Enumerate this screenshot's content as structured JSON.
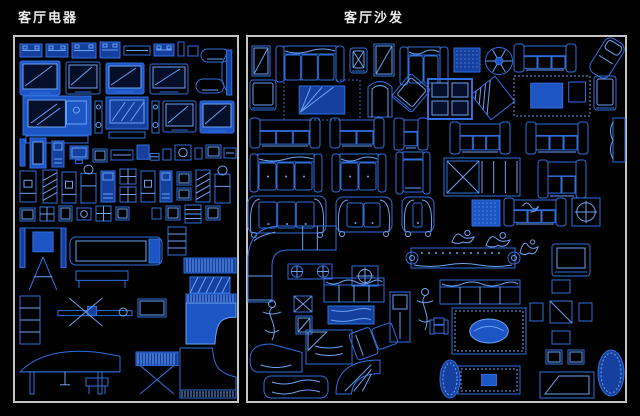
{
  "app": {
    "kind": "cad-block-library-sheet",
    "background": "#000000"
  },
  "colors": {
    "line": "#2f6fe0",
    "bright": "#6aa2f2",
    "fill": "#1d55c4",
    "dfill": "#16409f",
    "screen": "#060f2a",
    "border": "#c4c4c4",
    "title": "#ececec"
  },
  "panels": [
    {
      "id": "appliances",
      "title": "客厅电器",
      "frame": {
        "x": 14,
        "y": 36,
        "w": 224,
        "h": 366
      },
      "title_pos": {
        "x": 18,
        "y": 7
      },
      "items": [
        {
          "t": "unit",
          "x": 20,
          "y": 44,
          "w": 22,
          "h": 13
        },
        {
          "t": "unit",
          "x": 46,
          "y": 44,
          "w": 22,
          "h": 13
        },
        {
          "t": "unit",
          "x": 72,
          "y": 43,
          "w": 24,
          "h": 15
        },
        {
          "t": "unit",
          "x": 100,
          "y": 42,
          "w": 20,
          "h": 16
        },
        {
          "t": "flat",
          "x": 124,
          "y": 46,
          "w": 26,
          "h": 9
        },
        {
          "t": "unit",
          "x": 154,
          "y": 44,
          "w": 20,
          "h": 12
        },
        {
          "t": "tiny",
          "x": 178,
          "y": 42,
          "w": 6,
          "h": 14
        },
        {
          "t": "tiny",
          "x": 188,
          "y": 46,
          "w": 10,
          "h": 10
        },
        {
          "t": "lounge",
          "x": 201,
          "y": 49,
          "w": 28,
          "h": 13
        },
        {
          "t": "tv",
          "x": 20,
          "y": 61,
          "w": 40,
          "h": 34,
          "f": 1
        },
        {
          "t": "tv",
          "x": 66,
          "y": 62,
          "w": 34,
          "h": 32
        },
        {
          "t": "tv",
          "x": 106,
          "y": 63,
          "w": 38,
          "h": 31,
          "f": 1
        },
        {
          "t": "tv",
          "x": 150,
          "y": 64,
          "w": 38,
          "h": 30
        },
        {
          "t": "lounge",
          "x": 196,
          "y": 79,
          "w": 28,
          "h": 14
        },
        {
          "t": "tvside",
          "x": 222,
          "y": 50,
          "w": 13,
          "h": 45
        },
        {
          "t": "bigtv",
          "x": 23,
          "y": 96,
          "w": 68,
          "h": 47
        },
        {
          "t": "spk2",
          "x": 95,
          "y": 101,
          "w": 7,
          "h": 32
        },
        {
          "t": "hatchtv",
          "x": 106,
          "y": 97,
          "w": 42,
          "h": 32
        },
        {
          "t": "spk2",
          "x": 152,
          "y": 101,
          "w": 7,
          "h": 32
        },
        {
          "t": "tv",
          "x": 163,
          "y": 101,
          "w": 33,
          "h": 31
        },
        {
          "t": "tv",
          "x": 200,
          "y": 101,
          "w": 34,
          "h": 32,
          "f": 1
        },
        {
          "t": "pen",
          "x": 20,
          "y": 139,
          "w": 5,
          "h": 27
        },
        {
          "t": "darkcol",
          "x": 30,
          "y": 138,
          "w": 16,
          "h": 30
        },
        {
          "t": "col",
          "x": 52,
          "y": 141,
          "w": 12,
          "h": 26
        },
        {
          "t": "pc",
          "x": 70,
          "y": 146,
          "w": 18,
          "h": 18
        },
        {
          "t": "box",
          "x": 93,
          "y": 149,
          "w": 14,
          "h": 13
        },
        {
          "t": "flat",
          "x": 111,
          "y": 150,
          "w": 22,
          "h": 10
        },
        {
          "t": "pckb",
          "x": 137,
          "y": 145,
          "w": 22,
          "h": 19
        },
        {
          "t": "tiny",
          "x": 163,
          "y": 149,
          "w": 8,
          "h": 11
        },
        {
          "t": "boxc",
          "x": 175,
          "y": 145,
          "w": 16,
          "h": 15
        },
        {
          "t": "tiny",
          "x": 195,
          "y": 148,
          "w": 7,
          "h": 11
        },
        {
          "t": "box",
          "x": 206,
          "y": 145,
          "w": 15,
          "h": 13
        },
        {
          "t": "flat",
          "x": 224,
          "y": 148,
          "w": 12,
          "h": 10
        },
        {
          "t": "disp",
          "x": 20,
          "y": 171,
          "w": 16,
          "h": 31
        },
        {
          "t": "colh",
          "x": 43,
          "y": 170,
          "w": 14,
          "h": 33
        },
        {
          "t": "disp",
          "x": 62,
          "y": 172,
          "w": 14,
          "h": 31
        },
        {
          "t": "bottle",
          "x": 81,
          "y": 165,
          "w": 15,
          "h": 38
        },
        {
          "t": "col",
          "x": 101,
          "y": 171,
          "w": 14,
          "h": 31
        },
        {
          "t": "gridbox",
          "x": 120,
          "y": 169,
          "w": 16,
          "h": 15
        },
        {
          "t": "gridbox",
          "x": 120,
          "y": 187,
          "w": 16,
          "h": 15
        },
        {
          "t": "disp",
          "x": 141,
          "y": 171,
          "w": 14,
          "h": 31
        },
        {
          "t": "col",
          "x": 160,
          "y": 171,
          "w": 12,
          "h": 31
        },
        {
          "t": "box",
          "x": 177,
          "y": 172,
          "w": 14,
          "h": 13
        },
        {
          "t": "box",
          "x": 177,
          "y": 188,
          "w": 14,
          "h": 12
        },
        {
          "t": "colh",
          "x": 196,
          "y": 170,
          "w": 14,
          "h": 32
        },
        {
          "t": "bottle",
          "x": 215,
          "y": 166,
          "w": 15,
          "h": 37
        },
        {
          "t": "box",
          "x": 20,
          "y": 208,
          "w": 15,
          "h": 13
        },
        {
          "t": "gridbox",
          "x": 40,
          "y": 207,
          "w": 14,
          "h": 14
        },
        {
          "t": "box",
          "x": 59,
          "y": 206,
          "w": 13,
          "h": 15
        },
        {
          "t": "boxc",
          "x": 77,
          "y": 208,
          "w": 14,
          "h": 12
        },
        {
          "t": "gridbox",
          "x": 96,
          "y": 206,
          "w": 15,
          "h": 15
        },
        {
          "t": "box",
          "x": 116,
          "y": 207,
          "w": 13,
          "h": 13
        },
        {
          "t": "tiny",
          "x": 152,
          "y": 208,
          "w": 9,
          "h": 11
        },
        {
          "t": "box",
          "x": 166,
          "y": 206,
          "w": 14,
          "h": 14
        },
        {
          "t": "gridstack",
          "x": 185,
          "y": 205,
          "w": 16,
          "h": 18
        },
        {
          "t": "box",
          "x": 206,
          "y": 206,
          "w": 14,
          "h": 14
        },
        {
          "t": "machine",
          "x": 20,
          "y": 224,
          "w": 46,
          "h": 66
        },
        {
          "t": "treadmill",
          "x": 70,
          "y": 237,
          "w": 92,
          "h": 28
        },
        {
          "t": "bench",
          "x": 76,
          "y": 271,
          "w": 52,
          "h": 17
        },
        {
          "t": "gridstack",
          "x": 168,
          "y": 227,
          "w": 18,
          "h": 28
        },
        {
          "t": "keys",
          "x": 184,
          "y": 258,
          "w": 52,
          "h": 15
        },
        {
          "t": "hatchbox",
          "x": 190,
          "y": 277,
          "w": 40,
          "h": 16
        },
        {
          "t": "rack",
          "x": 20,
          "y": 296,
          "w": 20,
          "h": 48
        },
        {
          "t": "rowing",
          "x": 58,
          "y": 298,
          "w": 74,
          "h": 28
        },
        {
          "t": "box",
          "x": 138,
          "y": 299,
          "w": 28,
          "h": 18
        },
        {
          "t": "gpianoT",
          "x": 186,
          "y": 294,
          "w": 50,
          "h": 50
        },
        {
          "t": "gpianoS",
          "x": 20,
          "y": 348,
          "w": 100,
          "h": 46
        },
        {
          "t": "stool",
          "x": 86,
          "y": 378,
          "w": 22,
          "h": 16
        },
        {
          "t": "synthstand",
          "x": 136,
          "y": 352,
          "w": 42,
          "h": 42
        },
        {
          "t": "gpianoO",
          "x": 180,
          "y": 348,
          "w": 56,
          "h": 50
        }
      ]
    },
    {
      "id": "sofas",
      "title": "客厅沙发",
      "frame": {
        "x": 247,
        "y": 36,
        "w": 379,
        "h": 366
      },
      "title_pos": {
        "x": 344,
        "y": 7
      },
      "items": [
        {
          "t": "cab",
          "x": 252,
          "y": 46,
          "w": 18,
          "h": 30
        },
        {
          "t": "sofa3top",
          "x": 276,
          "y": 46,
          "w": 68,
          "h": 36,
          "n": 3
        },
        {
          "t": "armtop",
          "x": 350,
          "y": 48,
          "w": 17,
          "h": 25,
          "X": 1
        },
        {
          "t": "cab",
          "x": 374,
          "y": 44,
          "w": 20,
          "h": 32
        },
        {
          "t": "sofa3top",
          "x": 400,
          "y": 47,
          "w": 48,
          "h": 38,
          "n": 2
        },
        {
          "t": "dotsq",
          "x": 454,
          "y": 48,
          "w": 26,
          "h": 24
        },
        {
          "t": "flower",
          "x": 484,
          "y": 46,
          "w": 30,
          "h": 30
        },
        {
          "t": "sofafront",
          "x": 514,
          "y": 44,
          "w": 62,
          "h": 28,
          "n": 3
        },
        {
          "t": "rotlounge",
          "x": 596,
          "y": 38,
          "w": 22,
          "h": 40,
          "r": 32
        },
        {
          "t": "armtop",
          "x": 250,
          "y": 80,
          "w": 26,
          "h": 30
        },
        {
          "t": "setrug",
          "x": 284,
          "y": 80,
          "w": 76,
          "h": 40
        },
        {
          "t": "wing",
          "x": 368,
          "y": 79,
          "w": 24,
          "h": 38
        },
        {
          "t": "armtop",
          "x": 398,
          "y": 78,
          "w": 26,
          "h": 30,
          "r": 40
        },
        {
          "t": "win4",
          "x": 428,
          "y": 79,
          "w": 44,
          "h": 40
        },
        {
          "t": "hatchsq",
          "x": 478,
          "y": 82,
          "w": 30,
          "h": 32,
          "r": -38
        },
        {
          "t": "set",
          "x": 514,
          "y": 76,
          "w": 76,
          "h": 40
        },
        {
          "t": "armtop",
          "x": 594,
          "y": 76,
          "w": 22,
          "h": 34
        },
        {
          "t": "sofaside",
          "x": 613,
          "y": 118,
          "w": 12,
          "h": 44
        },
        {
          "t": "sofafront",
          "x": 250,
          "y": 118,
          "w": 70,
          "h": 30,
          "n": 3
        },
        {
          "t": "sofafront",
          "x": 330,
          "y": 118,
          "w": 54,
          "h": 30,
          "n": 2
        },
        {
          "t": "sofafront",
          "x": 394,
          "y": 118,
          "w": 34,
          "h": 32,
          "n": 1
        },
        {
          "t": "sofafront",
          "x": 450,
          "y": 122,
          "w": 60,
          "h": 32,
          "n": 3
        },
        {
          "t": "sofafront",
          "x": 526,
          "y": 122,
          "w": 62,
          "h": 32,
          "n": 3
        },
        {
          "t": "sofa3top",
          "x": 250,
          "y": 154,
          "w": 72,
          "h": 38,
          "n": 3,
          "dots": 1
        },
        {
          "t": "sofa3top",
          "x": 332,
          "y": 154,
          "w": 54,
          "h": 38,
          "n": 2,
          "dots": 1
        },
        {
          "t": "sofa1top",
          "x": 396,
          "y": 152,
          "w": 34,
          "h": 42
        },
        {
          "t": "diamondbench",
          "x": 444,
          "y": 158,
          "w": 76,
          "h": 38
        },
        {
          "t": "sofafront",
          "x": 538,
          "y": 160,
          "w": 48,
          "h": 38,
          "n": 2
        },
        {
          "t": "sofa3arch",
          "x": 248,
          "y": 196,
          "w": 78,
          "h": 42,
          "n": 3
        },
        {
          "t": "sofa3arch",
          "x": 336,
          "y": 197,
          "w": 56,
          "h": 40,
          "n": 2
        },
        {
          "t": "sofa3arch",
          "x": 402,
          "y": 197,
          "w": 32,
          "h": 40,
          "n": 1
        },
        {
          "t": "dotsq",
          "x": 472,
          "y": 200,
          "w": 28,
          "h": 26,
          "f": 1
        },
        {
          "t": "catsofa",
          "x": 504,
          "y": 198,
          "w": 62,
          "h": 28
        },
        {
          "t": "targetbox",
          "x": 572,
          "y": 198,
          "w": 28,
          "h": 28
        },
        {
          "t": "sofaL",
          "x": 248,
          "y": 226,
          "w": 88,
          "h": 76
        },
        {
          "t": "targetbox",
          "x": 352,
          "y": 266,
          "w": 26,
          "h": 20
        },
        {
          "t": "Xbench",
          "x": 288,
          "y": 264,
          "w": 44,
          "h": 15
        },
        {
          "t": "scrollbench",
          "x": 404,
          "y": 244,
          "w": 118,
          "h": 28
        },
        {
          "t": "armfront",
          "x": 552,
          "y": 244,
          "w": 38,
          "h": 32
        },
        {
          "t": "fig",
          "x": 452,
          "y": 228,
          "w": 22,
          "h": 20
        },
        {
          "t": "fig",
          "x": 486,
          "y": 230,
          "w": 24,
          "h": 22
        },
        {
          "t": "fig",
          "x": 520,
          "y": 236,
          "w": 18,
          "h": 24
        },
        {
          "t": "sofa4top",
          "x": 324,
          "y": 278,
          "w": 60,
          "h": 24
        },
        {
          "t": "sofa4top",
          "x": 440,
          "y": 280,
          "w": 80,
          "h": 24
        },
        {
          "t": "person",
          "x": 262,
          "y": 300,
          "w": 20,
          "h": 40
        },
        {
          "t": "smtable",
          "x": 294,
          "y": 296,
          "w": 18,
          "h": 16
        },
        {
          "t": "cab",
          "x": 296,
          "y": 316,
          "w": 16,
          "h": 18
        },
        {
          "t": "rugsm",
          "x": 328,
          "y": 306,
          "w": 46,
          "h": 18
        },
        {
          "t": "tallcab",
          "x": 390,
          "y": 292,
          "w": 20,
          "h": 50
        },
        {
          "t": "person",
          "x": 416,
          "y": 288,
          "w": 18,
          "h": 42
        },
        {
          "t": "minisofa",
          "x": 430,
          "y": 318,
          "w": 18,
          "h": 16
        },
        {
          "t": "rugoval",
          "x": 452,
          "y": 308,
          "w": 74,
          "h": 46
        },
        {
          "t": "table4",
          "x": 530,
          "y": 280,
          "w": 62,
          "h": 64
        },
        {
          "t": "box",
          "x": 546,
          "y": 350,
          "w": 16,
          "h": 14
        },
        {
          "t": "box",
          "x": 568,
          "y": 350,
          "w": 16,
          "h": 14
        },
        {
          "t": "chaiseC",
          "x": 250,
          "y": 344,
          "w": 52,
          "h": 28
        },
        {
          "t": "daybed",
          "x": 306,
          "y": 330,
          "w": 46,
          "h": 34
        },
        {
          "t": "bigchaise",
          "x": 264,
          "y": 376,
          "w": 64,
          "h": 22
        },
        {
          "t": "fanchaise",
          "x": 336,
          "y": 360,
          "w": 44,
          "h": 34
        },
        {
          "t": "recliner",
          "x": 352,
          "y": 326,
          "w": 44,
          "h": 28,
          "r": -20
        },
        {
          "t": "rugoval",
          "x": 458,
          "y": 366,
          "w": 62,
          "h": 28,
          "small": 1
        },
        {
          "t": "benchtrap",
          "x": 540,
          "y": 372,
          "w": 54,
          "h": 26
        },
        {
          "t": "ruground",
          "x": 598,
          "y": 350,
          "w": 26,
          "h": 46
        },
        {
          "t": "ruground",
          "x": 440,
          "y": 360,
          "w": 20,
          "h": 38
        }
      ]
    }
  ]
}
